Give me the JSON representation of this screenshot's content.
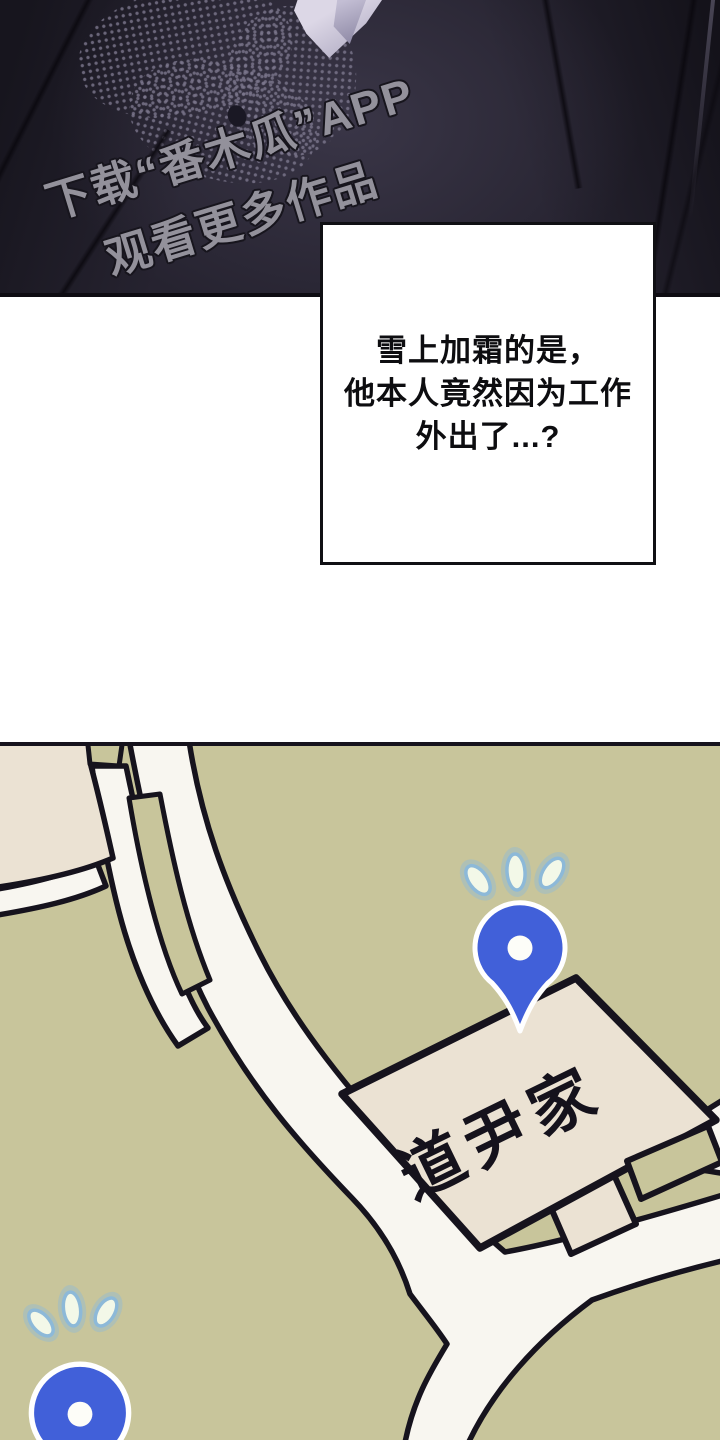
{
  "top_panel": {
    "watermark_line1": "下载“番木瓜”APP",
    "watermark_line2": "观看更多作品"
  },
  "caption": {
    "lines": [
      "雪上加霜的是，",
      "他本人竟然因为工作",
      "外出了...?"
    ]
  },
  "map": {
    "sign_label": "道尹家"
  },
  "colors": {
    "panel-dark": "#262330",
    "map-bg": "#c8c59b",
    "map-road": "#f8f6f0",
    "map-outline": "#16131d",
    "map-block": "#ebe2d3",
    "pin-blue": "#4160d9",
    "pin-hole": "#fdfdf8",
    "mark-fill": "#f3f8e8",
    "mark-glow": "#8db9d8",
    "watermark-gray": "#93919b"
  }
}
